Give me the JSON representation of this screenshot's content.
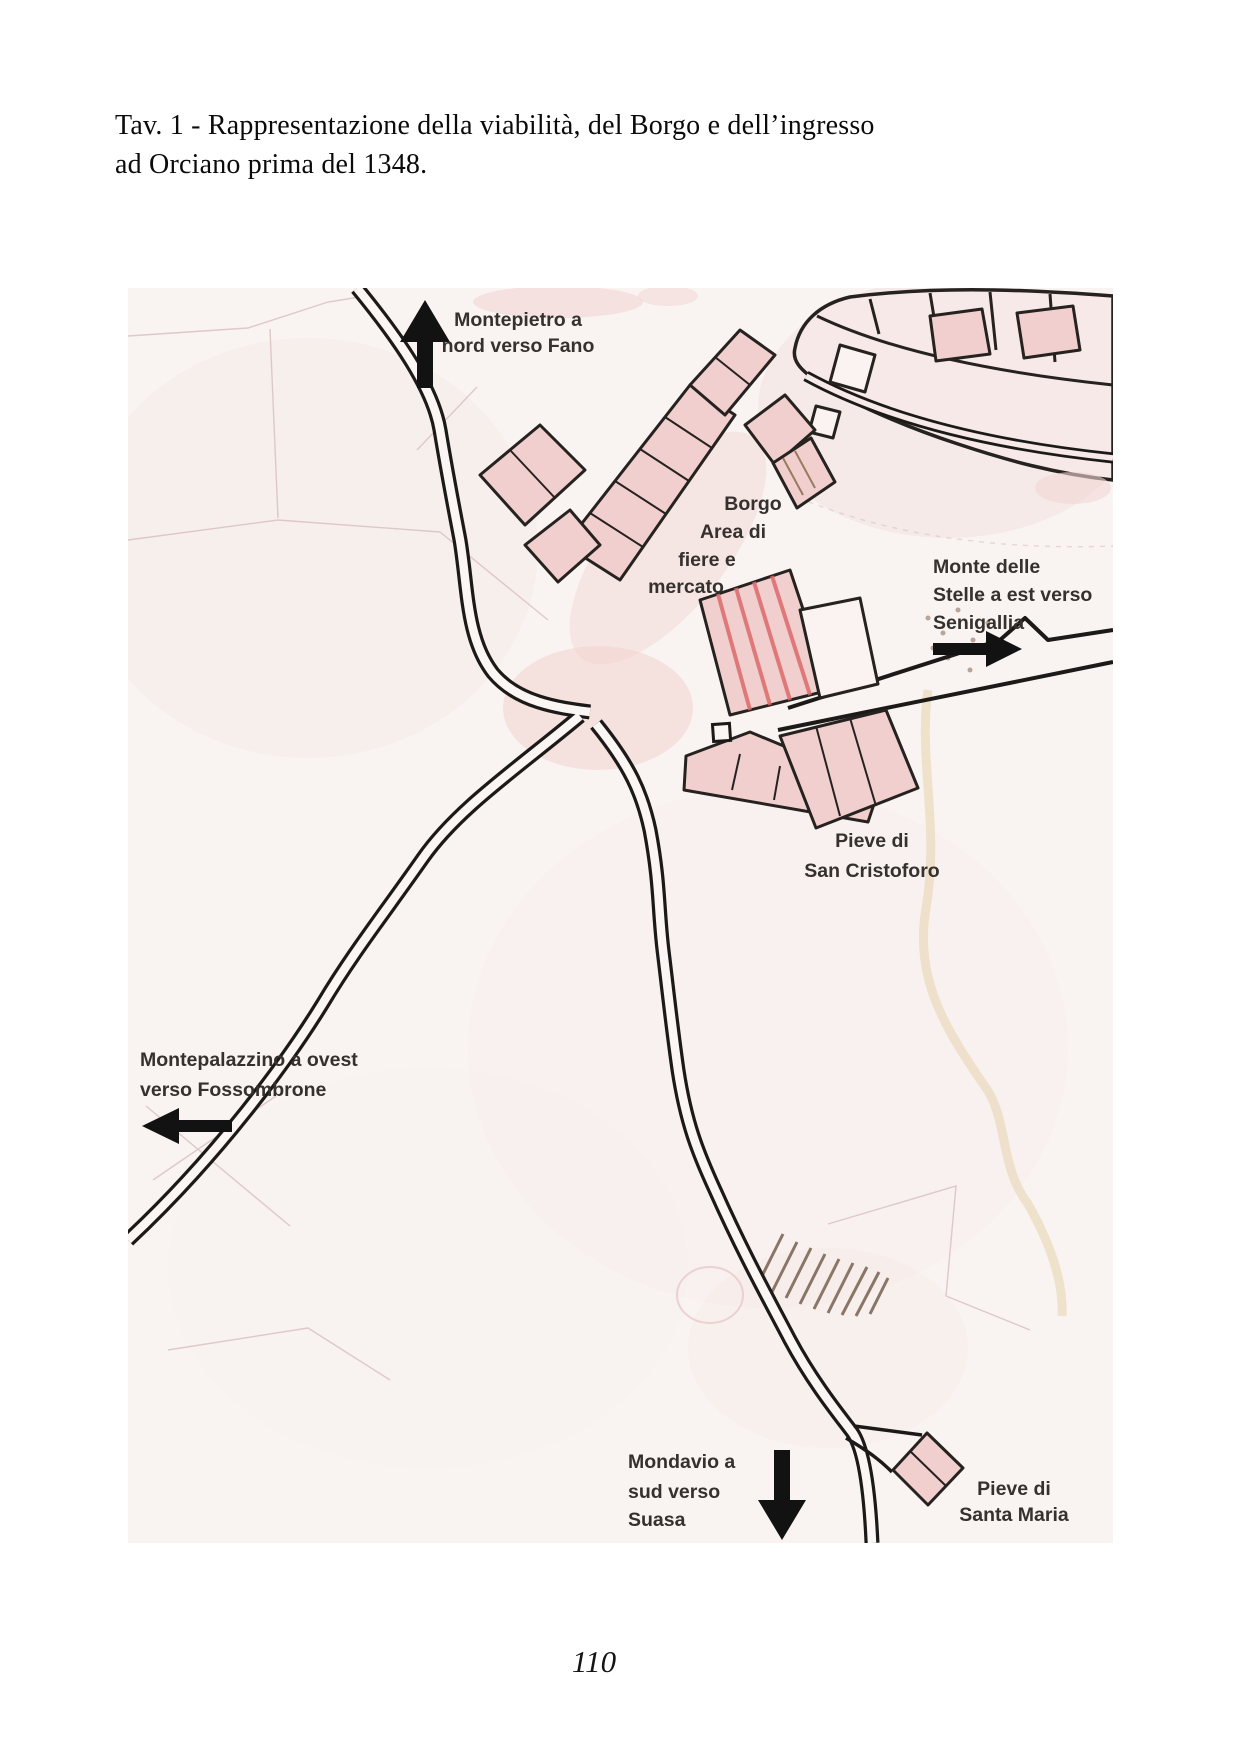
{
  "document": {
    "caption": {
      "line1": "Tav. 1 - Rappresentazione della viabilità, del Borgo e dell’ingresso",
      "line2": "ad Orciano prima del 1348."
    },
    "page_number": "110"
  },
  "map": {
    "labels": {
      "montepietro": {
        "lines": [
          "Montepietro a",
          "nord verso Fano"
        ]
      },
      "borgo": {
        "lines": [
          "Borgo",
          "Area di",
          "fiere e",
          "mercato"
        ]
      },
      "monte_stelle": {
        "lines": [
          "Monte delle",
          "Stelle a est verso",
          "Senigallia"
        ]
      },
      "pieve_san_cristoforo": {
        "lines": [
          "Pieve di",
          "San Cristoforo"
        ]
      },
      "montepalazzino": {
        "lines": [
          "Montepalazzino a ovest",
          "verso Fossombrone"
        ]
      },
      "mondavio": {
        "lines": [
          "Mondavio a",
          "sud verso",
          "Suasa"
        ]
      },
      "pieve_santa_maria": {
        "lines": [
          "Pieve di",
          "Santa Maria"
        ]
      }
    },
    "arrow_icons": [
      "north-arrow",
      "east-arrow",
      "west-arrow",
      "south-arrow"
    ],
    "colors": {
      "road_line": "#1c1a19",
      "building_fill": "#f1cfcf",
      "building_stroke": "#26221f",
      "label_text": "#35312e",
      "paper_tint": "#f9f4f2",
      "red_hatch": "#dd6a6a",
      "stream_tint": "#e8d5b0"
    }
  }
}
